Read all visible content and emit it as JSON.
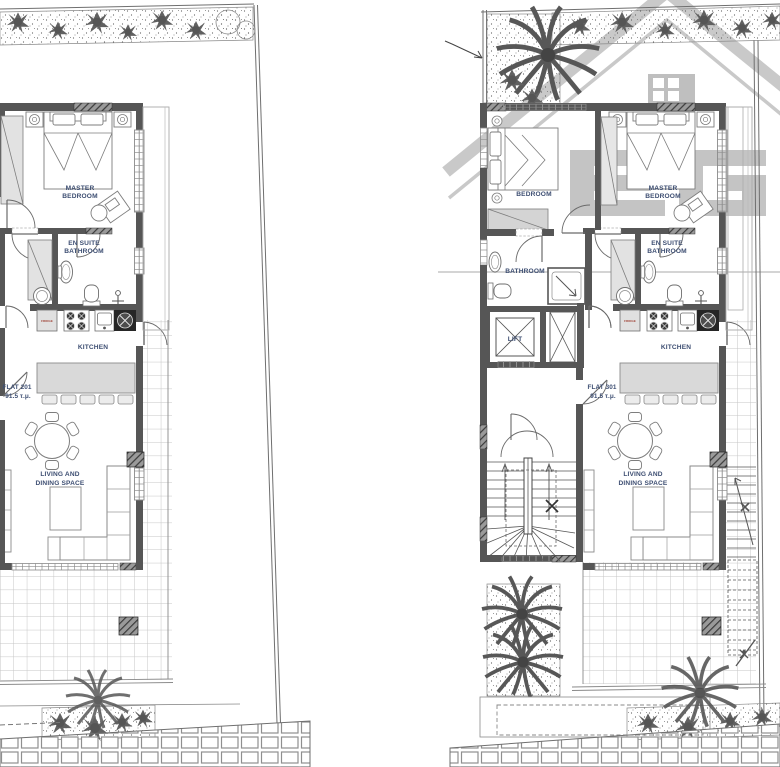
{
  "document": {
    "type": "architectural floor plan, two flats side by side"
  },
  "watermark": {
    "letters": "EG"
  },
  "left_plan": {
    "flat_name": "FLAT 201",
    "flat_area": "91.5 τ.μ."
  },
  "right_plan": {
    "flat_name": "FLAT 301",
    "flat_area": "91.5 τ.μ."
  },
  "rooms": {
    "master_1": "MASTER",
    "master_2": "BEDROOM",
    "ensuite_1": "EN SUITE",
    "ensuite_2": "BATHROOM",
    "kitchen": "KITCHEN",
    "living_1": "LIVING AND",
    "living_2": "DINING SPACE",
    "bedroom": "BEDROOM",
    "bathroom": "BATHROOM",
    "lift": "LIFT",
    "fridge": "FRIDGE"
  },
  "colors": {
    "wall": "#565656",
    "label_text": "#3d4e72",
    "fridge_text": "#a2493d",
    "watermark": "#bfbfbf",
    "terrace_grid": "#c6c6c6"
  }
}
